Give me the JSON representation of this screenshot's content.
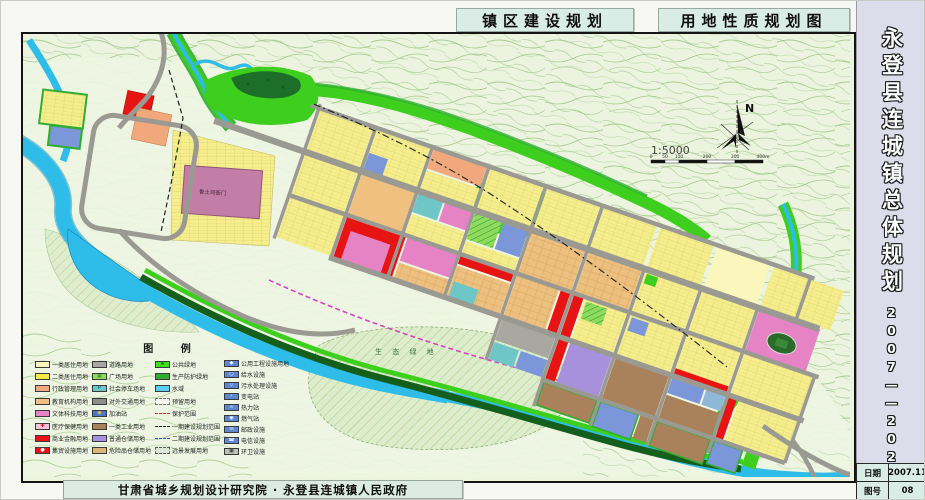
{
  "header": {
    "title_left": "镇区建设规划",
    "title_right": "用地性质规划图"
  },
  "title_block": {
    "project": "永登县连城镇总体规划",
    "period": "2007——2020",
    "date_label": "日期",
    "date_value": "2007.11",
    "sheet_label": "图号",
    "sheet_value": "08"
  },
  "footer": {
    "credit": "甘肃省城乡规划设计研究院 · 永登县连城镇人民政府"
  },
  "map": {
    "north_label": "N",
    "scale_text": "1:5000",
    "scale_ticks": [
      "0",
      "50",
      "100",
      "200",
      "300",
      "400m"
    ],
    "labels": {
      "historic_site": "鲁土司衙门",
      "eco_green": "生 态 绿 地"
    },
    "palette": {
      "residential_yellow": "#f6ee8d",
      "commercial_red": "#e81414",
      "road_gray": "#9a9a92",
      "water_cyan": "#2ebde9",
      "public_green": "#3ecf1e",
      "protective_green": "#2fae2f",
      "education_orange": "#f0a87c",
      "culture_pink": "#e583c5",
      "historic_mauve": "#c27ea6",
      "warehouse_purple": "#a891dc",
      "industry_brown": "#a9825c",
      "utility_blue": "#5d86d0",
      "parking_teal": "#6fc6c6",
      "topo_contour": "#a9cd92"
    }
  },
  "legend": {
    "title": "图  例",
    "columns": [
      {
        "items": [
          {
            "label": "一类居住用地",
            "type": "solid",
            "color": "#faf6bc"
          },
          {
            "label": "二类居住用地",
            "type": "solid",
            "color": "#f6e94e"
          },
          {
            "label": "行政管理用地",
            "type": "solid",
            "color": "#f0a87c"
          },
          {
            "label": "教育机构用地",
            "type": "solid",
            "color": "#f2bd82"
          },
          {
            "label": "文体科技用地",
            "type": "solid",
            "color": "#e583c5"
          },
          {
            "label": "医疗保健用地",
            "type": "glyph",
            "color": "#f6c3d8",
            "glyph": "✚",
            "glyph_color": "#e00000"
          },
          {
            "label": "商业金融用地",
            "type": "solid",
            "color": "#e81414"
          },
          {
            "label": "集贸设施用地",
            "type": "glyph",
            "color": "#e81414",
            "glyph": "●",
            "glyph_color": "#ffffff"
          }
        ]
      },
      {
        "items": [
          {
            "label": "道路用地",
            "type": "solid",
            "color": "#a8a8a0"
          },
          {
            "label": "广场用地",
            "type": "glyph",
            "color": "#8edb5e",
            "glyph": "▦",
            "glyph_color": "#2f7f2f"
          },
          {
            "label": "社会停车场地",
            "type": "glyph",
            "color": "#6fc6c6",
            "glyph": "P",
            "glyph_color": "#16457f"
          },
          {
            "label": "对外交通用地",
            "type": "solid",
            "color": "#8f8f89"
          },
          {
            "label": "加油站",
            "type": "glyph",
            "color": "#4a76c8",
            "glyph": "◉",
            "glyph_color": "#ffd020"
          },
          {
            "label": "一类工业用地",
            "type": "solid",
            "color": "#a9825c"
          },
          {
            "label": "普通仓储用地",
            "type": "solid",
            "color": "#a891dc"
          },
          {
            "label": "危险品仓储用地",
            "type": "solid",
            "color": "#dcb678"
          }
        ]
      },
      {
        "items": [
          {
            "label": "公共绿地",
            "type": "glyph",
            "color": "#3fdf1f",
            "glyph": "♣",
            "glyph_color": "#157a15"
          },
          {
            "label": "生产防护绿地",
            "type": "solid",
            "color": "#2fae2f"
          },
          {
            "label": "水域",
            "type": "solid",
            "color": "#59cdf2"
          },
          {
            "label": "预留用地",
            "type": "reserve",
            "color": "#f4f8ee"
          },
          {
            "label": "保护范围",
            "type": "line",
            "color": "#e03030",
            "line_style": "dashed"
          },
          {
            "label": "一期建设规划范围",
            "type": "line",
            "color": "#222222",
            "line_style": "dashed"
          },
          {
            "label": "二期建设规划范围",
            "type": "line",
            "color": "#3355cc",
            "line_style": "dashed"
          },
          {
            "label": "远景发展用地",
            "type": "boxdash",
            "color": "#dfe7d8"
          }
        ]
      },
      {
        "items": [
          {
            "label": "公用工程设施用地",
            "type": "glyph",
            "color": "#5d86d0",
            "glyph": "◆",
            "glyph_color": "#ffffff"
          },
          {
            "label": "给水设施",
            "type": "glyph",
            "color": "#5d86d0",
            "glyph": "○",
            "glyph_color": "#ffffff"
          },
          {
            "label": "污水处理设施",
            "type": "glyph",
            "color": "#5d86d0",
            "glyph": "▽",
            "glyph_color": "#ffffff"
          },
          {
            "label": "变电站",
            "type": "glyph",
            "color": "#5d86d0",
            "glyph": "⚡",
            "glyph_color": "#ffe020"
          },
          {
            "label": "热力站",
            "type": "glyph",
            "color": "#5d86d0",
            "glyph": "≈",
            "glyph_color": "#ffffff"
          },
          {
            "label": "燃气站",
            "type": "glyph",
            "color": "#5d86d0",
            "glyph": "◉",
            "glyph_color": "#ffffff"
          },
          {
            "label": "邮政设施",
            "type": "glyph",
            "color": "#5d86d0",
            "glyph": "✉",
            "glyph_color": "#ffffff"
          },
          {
            "label": "电信设施",
            "type": "glyph",
            "color": "#5d86d0",
            "glyph": "☎",
            "glyph_color": "#ffffff"
          },
          {
            "label": "环卫设施",
            "type": "glyph",
            "color": "#b9c2b4",
            "glyph": "▣",
            "glyph_color": "#333333"
          }
        ]
      }
    ]
  }
}
